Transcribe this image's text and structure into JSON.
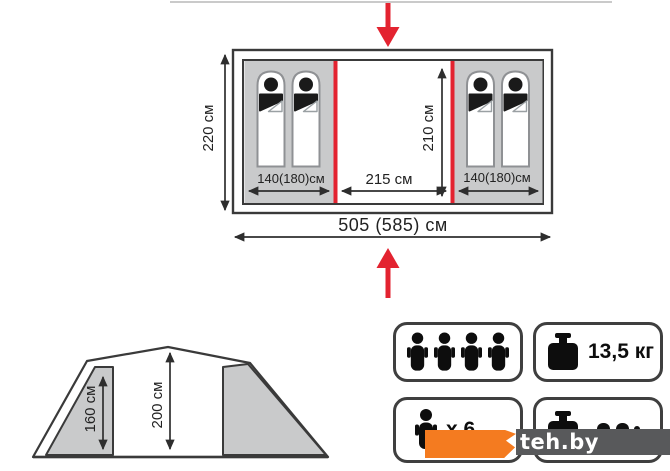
{
  "colors": {
    "accent_red": "#e32330",
    "panel_gray": "#c9cacb",
    "outline": "#3a3a3a",
    "watermark_orange": "#f47b20",
    "watermark_gray": "#58595b"
  },
  "floor_plan": {
    "overall_width_label": "505 (585) см",
    "overall_depth_label": "220 см",
    "inner_depth_label": "210 см",
    "center_width_label": "215 см",
    "left_room_width_label": "140(180)см",
    "right_room_width_label": "140(180)см",
    "sleeping_bags_left": 2,
    "sleeping_bags_right": 2
  },
  "side_view": {
    "side_height_label": "160 см",
    "center_height_label": "200 см"
  },
  "spec_badges": {
    "capacity": {
      "icon": "people-icons",
      "person_count": 4
    },
    "weight": {
      "icon": "kettlebell-icon",
      "label": "13,5 кг"
    },
    "capacity_alt": {
      "icon": "person-icon",
      "label": "х 6"
    },
    "weight_alt": {
      "icon": "kettlebell-icon",
      "label_obscured_by_watermark": true
    }
  },
  "watermark": {
    "text": "teh.by"
  }
}
